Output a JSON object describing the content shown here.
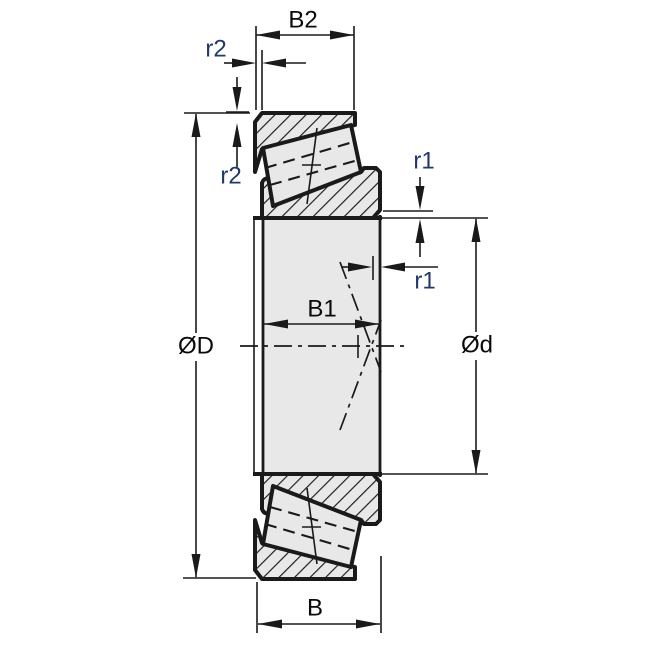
{
  "figure": {
    "type": "technical-drawing",
    "subject": "tapered-roller-bearing-cross-section"
  },
  "labels": {
    "cup_width": "B2",
    "outer_chamfer_top": "r2",
    "outer_chamfer_left": "r2",
    "inner_chamfer_upper": "r1",
    "inner_chamfer_lower": "r1",
    "cone_width": "B1",
    "outer_diameter": "ØD",
    "bore_diameter": "Ød",
    "total_width": "B"
  },
  "colors": {
    "background": "#ffffff",
    "part_fill": "#e8e8e8",
    "line": "#1a1a1a",
    "dim_label": "#0a0a0a",
    "radius_label": "#21386b"
  }
}
